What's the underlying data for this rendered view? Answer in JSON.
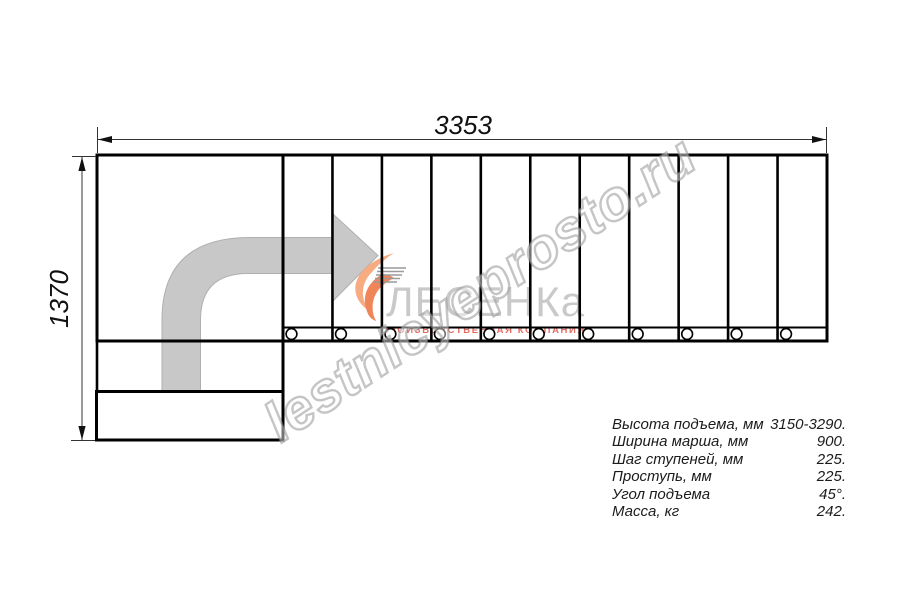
{
  "drawing": {
    "dim_width_label": "3353",
    "dim_height_label": "1370",
    "tread_count": 11,
    "baluster_count": 11,
    "line_color": "#000000",
    "arrow_color": "#c8c8c8",
    "arrow_edge_color": "#b0b0b0",
    "geometry": {
      "landing_right": 283,
      "right": 827,
      "flight_top": 155,
      "flight_bottom": 341,
      "band_y": 327.5,
      "baluster_cy": 334
    }
  },
  "logo": {
    "name": "ЛЕСЕНКа",
    "subtitle": "производственная компания",
    "accent_color": "#f0905f",
    "accent_light": "#f6b08a",
    "name_color": "#c7c7c7",
    "subtitle_color": "#e05146",
    "stripe_color": "#9a9a9a"
  },
  "watermark": {
    "text": "lestnicyeprosto.ru"
  },
  "specs": {
    "rows": [
      {
        "label": "Высота подъема, мм",
        "value": "3150-3290."
      },
      {
        "label": "Ширина марша, мм",
        "value": "900."
      },
      {
        "label": "Шаг ступеней, мм",
        "value": "225."
      },
      {
        "label": "Проступь, мм",
        "value": "225."
      },
      {
        "label": "Угол подъема",
        "value": "45°."
      },
      {
        "label": "Масса, кг",
        "value": "242."
      }
    ]
  }
}
